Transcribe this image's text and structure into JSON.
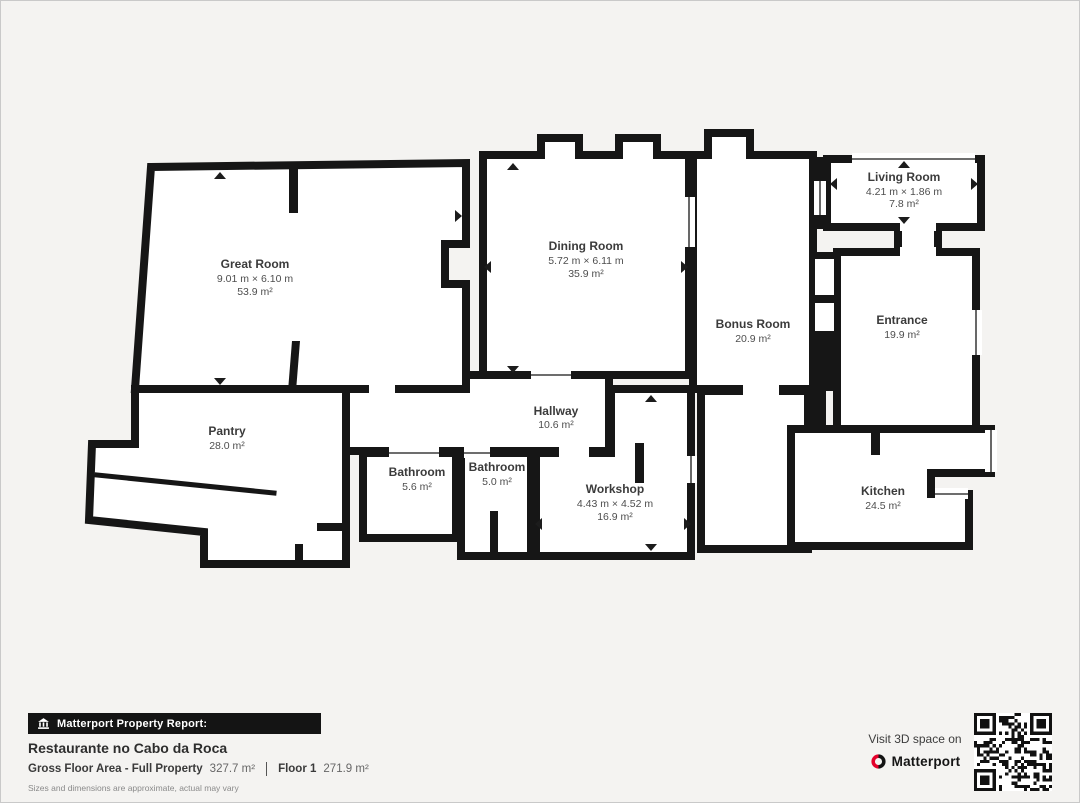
{
  "page": {
    "background": "#f4f3f1",
    "wall_color": "#161616"
  },
  "rooms": [
    {
      "id": "great-room",
      "name": "Great Room",
      "dims": "9.01 m × 6.10 m",
      "area": "53.9 m²"
    },
    {
      "id": "dining-room",
      "name": "Dining Room",
      "dims": "5.72 m × 6.11 m",
      "area": "35.9 m²"
    },
    {
      "id": "living-room",
      "name": "Living Room",
      "dims": "4.21 m × 1.86 m",
      "area": "7.8 m²"
    },
    {
      "id": "bonus-room",
      "name": "Bonus Room",
      "area": "20.9 m²"
    },
    {
      "id": "entrance",
      "name": "Entrance",
      "area": "19.9 m²"
    },
    {
      "id": "pantry",
      "name": "Pantry",
      "area": "28.0 m²"
    },
    {
      "id": "hallway",
      "name": "Hallway",
      "area": "10.6 m²"
    },
    {
      "id": "bathroom-1",
      "name": "Bathroom",
      "area": "5.6 m²"
    },
    {
      "id": "bathroom-2",
      "name": "Bathroom",
      "area": "5.0 m²"
    },
    {
      "id": "workshop",
      "name": "Workshop",
      "dims": "4.43 m × 4.52 m",
      "area": "16.9 m²"
    },
    {
      "id": "kitchen",
      "name": "Kitchen",
      "area": "24.5 m²"
    }
  ],
  "footer": {
    "report_label": "Matterport Property Report:",
    "property_name": "Restaurante no Cabo da Roca",
    "gross_label": "Gross Floor Area - Full Property",
    "gross_value": "327.7 m²",
    "floor_label": "Floor 1",
    "floor_value": "271.9 m²",
    "disclaimer": "Sizes and dimensions are approximate, actual may vary"
  },
  "cta": {
    "visit_text": "Visit 3D space on",
    "brand": "Matterport",
    "brand_red": "#e4002b"
  }
}
